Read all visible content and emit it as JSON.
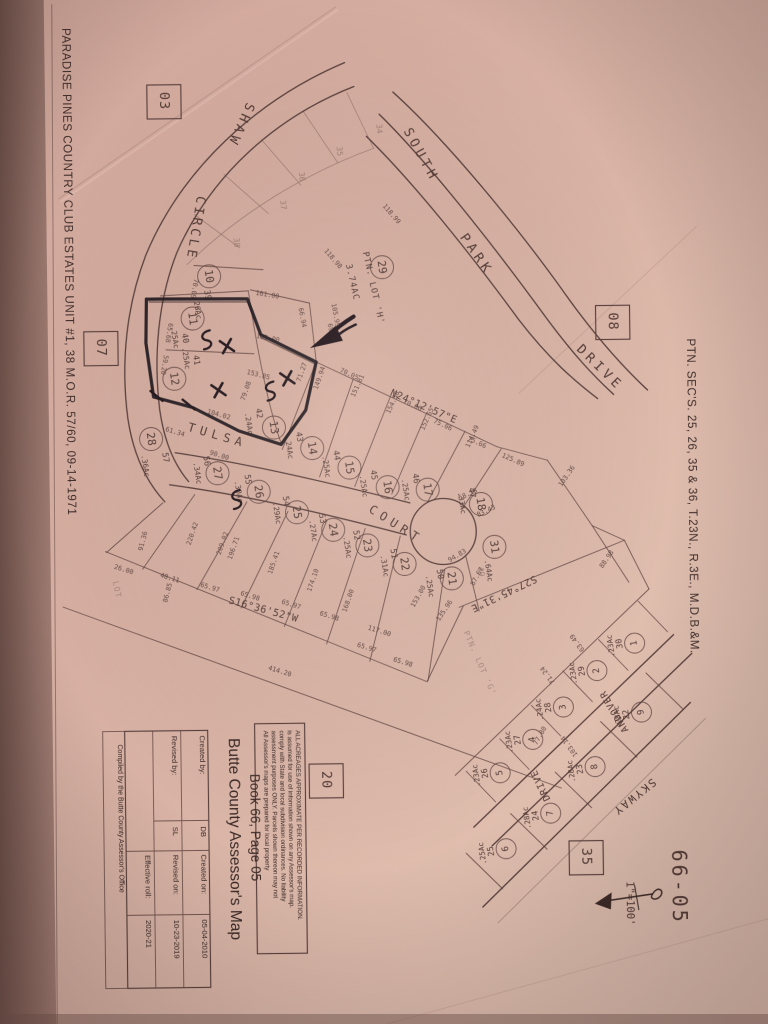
{
  "document": {
    "left_margin_title": "PARADISE PINES COUNTRY CLUB ESTATES UNIT #1, 38 M.O.R. 57/60, 09-14-1971",
    "right_margin_title": "PTN. SEC'S. 25, 26, 35 & 36, T.23N., R.3E., M.D.B.&M.",
    "map_number": "66-05",
    "scale_label": "1\"=100'"
  },
  "colors": {
    "paper": "#dcb6a8",
    "ink": "#5a403c",
    "annotation": "#20181c"
  },
  "title_block": {
    "org_title": "Butte County Assessor's Map",
    "book_page": "Book 66, Page 05",
    "disclaimer": [
      "All Assessor's maps are prepared for local property",
      "assessment purposes ONLY.  Parcels shown thereon may not",
      "comply with State and local subdivision ordinances.  No liability",
      "is assumed for use of information shown on any Assessor's map.",
      "ALL ACREAGES APPROXIMATE PER RECORDED INFORMATION."
    ],
    "created_by_label": "Created by:",
    "created_by_value": "DB",
    "created_on_label": "Created on:",
    "created_on_value": "05-04-2010",
    "revised_by_label": "Revised by:",
    "revised_by_value": "SL",
    "revised_on_label": "Revised on:",
    "revised_on_value": "10-23-2019",
    "effective_roll_label": "Effective roll:",
    "effective_roll_value": "2020-21",
    "compiled_by": "Compiled by the Butte County Assessor's Office"
  },
  "section_boxes": [
    {
      "label": "03",
      "x": 152,
      "y": 82
    },
    {
      "label": "07",
      "x": 86,
      "y": 328
    },
    {
      "label": "08",
      "x": 598,
      "y": 308
    },
    {
      "label": "20",
      "x": 306,
      "y": 763
    },
    {
      "label": "35",
      "x": 565,
      "y": 843
    }
  ],
  "streets": [
    {
      "t": "SHAW",
      "x": 252,
      "y": 100,
      "r": 115,
      "s": 13,
      "sp": 4
    },
    {
      "t": "CIRCLE",
      "x": 201,
      "y": 193,
      "r": 100,
      "s": 13,
      "sp": 3
    },
    {
      "t": "SOUTH",
      "x": 408,
      "y": 131,
      "r": 62,
      "s": 13,
      "sp": 4
    },
    {
      "t": "PARK",
      "x": 463,
      "y": 238,
      "r": 56,
      "s": 13,
      "sp": 4
    },
    {
      "t": "DRIVE",
      "x": 578,
      "y": 352,
      "r": 45,
      "s": 13,
      "sp": 4
    },
    {
      "t": "TULSA",
      "x": 188,
      "y": 428,
      "r": 17,
      "s": 12,
      "sp": 5
    },
    {
      "t": "COURT",
      "x": 368,
      "y": 511,
      "r": 33,
      "s": 12,
      "sp": 5
    },
    {
      "t": "ANDOVER",
      "x": 626,
      "y": 733,
      "r": -120,
      "s": 9.5,
      "sp": 1
    },
    {
      "t": "DRIVE",
      "x": 547,
      "y": 801,
      "r": -115,
      "s": 9.5,
      "sp": 1
    },
    {
      "t": "SKYWAY",
      "x": 649,
      "y": 781,
      "r": 142,
      "s": 11,
      "sp": 2
    }
  ],
  "bearings": [
    {
      "t": "N24°12'57\"E",
      "x": 391,
      "y": 395,
      "r": 24
    },
    {
      "t": "S16°36'52\"W",
      "x": 227,
      "y": 601,
      "r": 16
    },
    {
      "t": "S27°45'31\"E",
      "x": 534,
      "y": 577,
      "r": 155
    }
  ],
  "special_labels": [
    {
      "t": "PTN. LOT 'H'",
      "x": 366,
      "y": 252,
      "r": 78,
      "cls": "sp"
    },
    {
      "t": "3.74AC",
      "x": 349,
      "y": 264,
      "r": 78,
      "cls": "sp"
    },
    {
      "t": "PTN. LOT 'G'",
      "x": 462,
      "y": 633,
      "r": 67,
      "cls": "spf"
    },
    {
      "t": "LOT",
      "x": 112,
      "y": 578,
      "r": 80,
      "cls": "spf"
    }
  ],
  "faint_lot_numbers": [
    {
      "t": "34",
      "x": 381,
      "y": 124
    },
    {
      "t": "35",
      "x": 341,
      "y": 146
    },
    {
      "t": "36",
      "x": 303,
      "y": 171
    },
    {
      "t": "37",
      "x": 284,
      "y": 199
    },
    {
      "t": "38",
      "x": 237,
      "y": 236
    }
  ],
  "parcels": [
    {
      "num": "10",
      "lot": "39",
      "acre": ".26Ac",
      "cx": 212,
      "cy": 274,
      "lx": 207,
      "ly": 288,
      "ax": 196,
      "ay": 295,
      "rot": 82
    },
    {
      "num": "11",
      "lot": "40",
      "acre": ".25Ac",
      "cx": 195,
      "cy": 316,
      "lx": 184,
      "ly": 331,
      "ax": 173,
      "ay": 324,
      "rot": 82
    },
    {
      "num": "12",
      "lot": "41",
      "acre": ".25Ac",
      "cx": 176,
      "cy": 376,
      "lx": 195,
      "ly": 353,
      "ax": 184,
      "ay": 345,
      "rot": 82
    },
    {
      "num": "13",
      "lot": "42",
      "acre": ".24Ac",
      "cx": 275,
      "cy": 426,
      "lx": 257,
      "ly": 407,
      "ax": 246,
      "ay": 411,
      "rot": 82
    },
    {
      "num": "14",
      "lot": "43",
      "acre": ".24Ac",
      "cx": 313,
      "cy": 447,
      "lx": 297,
      "ly": 431,
      "ax": 286,
      "ay": 436,
      "rot": 82
    },
    {
      "num": "15",
      "lot": "44",
      "acre": ".25Ac",
      "cx": 350,
      "cy": 467,
      "lx": 334,
      "ly": 450,
      "ax": 323,
      "ay": 455,
      "rot": 82
    },
    {
      "num": "16",
      "lot": "45",
      "acre": ".25Ac",
      "cx": 388,
      "cy": 487,
      "lx": 371,
      "ly": 470,
      "ax": 360,
      "ay": 475,
      "rot": 82
    },
    {
      "num": "17",
      "lot": "46",
      "acre": ".25Ac",
      "cx": 428,
      "cy": 490,
      "lx": 413,
      "ly": 474,
      "ax": 402,
      "ay": 479,
      "rot": 82
    },
    {
      "num": "18",
      "lot": "47",
      "acre": ".33Ac",
      "cx": 481,
      "cy": 505,
      "lx": 469,
      "ly": 489,
      "ax": 458,
      "ay": 493,
      "rot": 82
    },
    {
      "num": "29",
      "lot": "",
      "acre": "",
      "cx": 385,
      "cy": 267,
      "lx": 0,
      "ly": 0,
      "ax": 0,
      "ay": 0,
      "rot": 82
    },
    {
      "num": "31",
      "lot": "49",
      "acre": ".64Ac",
      "cx": 494,
      "cy": 548,
      "lx": 477,
      "ly": 568,
      "ax": 484,
      "ay": 561,
      "rot": 82,
      "lotFaint": true
    },
    {
      "num": "21",
      "lot": "50",
      "acre": ".25Ac",
      "cx": 451,
      "cy": 579,
      "lx": 436,
      "ly": 570,
      "ax": 425,
      "ay": 576,
      "rot": 82
    },
    {
      "num": "22",
      "lot": "51",
      "acre": ".31Ac",
      "cx": 404,
      "cy": 564,
      "lx": 390,
      "ly": 549,
      "ax": 380,
      "ay": 555,
      "rot": 82
    },
    {
      "num": "23",
      "lot": "52",
      "acre": ".25Ac",
      "cx": 367,
      "cy": 545,
      "lx": 353,
      "ly": 530,
      "ax": 343,
      "ay": 536,
      "rot": 82
    },
    {
      "num": "24",
      "lot": "53",
      "acre": ".27Ac",
      "cx": 333,
      "cy": 529,
      "lx": 319,
      "ly": 513,
      "ax": 309,
      "ay": 519,
      "rot": 82
    },
    {
      "num": "25",
      "lot": "54",
      "acre": ".29Ac",
      "cx": 297,
      "cy": 511,
      "lx": 283,
      "ly": 495,
      "ax": 273,
      "ay": 501,
      "rot": 82
    },
    {
      "num": "26",
      "lot": "55",
      "acre": ".30Ac",
      "cx": 259,
      "cy": 490,
      "lx": 245,
      "ly": 473,
      "ax": 235,
      "ay": 479,
      "rot": 82
    },
    {
      "num": "27",
      "lot": "56",
      "acre": ".34Ac",
      "cx": 218,
      "cy": 471,
      "lx": 204,
      "ly": 454,
      "ax": 194,
      "ay": 460,
      "rot": 82
    },
    {
      "num": "28",
      "lot": "57",
      "acre": ".36Ac",
      "cx": 152,
      "cy": 436,
      "lx": 163,
      "ly": 450,
      "ax": 142,
      "ay": 452,
      "rot": 82
    },
    {
      "num": "1",
      "lot": "30",
      "acre": ".23Ac",
      "cx": 633,
      "cy": 646,
      "lx": 621,
      "ly": 651,
      "ax": 613,
      "ay": 659,
      "rot": -98,
      "small": true
    },
    {
      "num": "2",
      "lot": "29",
      "acre": ".23Ac",
      "cx": 595,
      "cy": 673,
      "lx": 583,
      "ly": 678,
      "ax": 575,
      "ay": 686,
      "rot": -98,
      "small": true
    },
    {
      "num": "3",
      "lot": "28",
      "acre": ".24Ac",
      "cx": 561,
      "cy": 709,
      "lx": 549,
      "ly": 714,
      "ax": 541,
      "ay": 722,
      "rot": -98,
      "small": true
    },
    {
      "num": "4",
      "lot": "27",
      "acre": ".23Ac",
      "cx": 530,
      "cy": 741,
      "lx": 518,
      "ly": 746,
      "ax": 510,
      "ay": 754,
      "rot": -98,
      "small": true
    },
    {
      "num": "5",
      "lot": "26",
      "acre": ".23Ac",
      "cx": 497,
      "cy": 774,
      "lx": 485,
      "ly": 779,
      "ax": 477,
      "ay": 787,
      "rot": -98,
      "small": true
    },
    {
      "num": "9",
      "lot": "22",
      "acre": ".28Ac",
      "cx": 639,
      "cy": 715,
      "lx": 627,
      "ly": 722,
      "ax": 619,
      "ay": 730,
      "rot": -98,
      "small": true
    },
    {
      "num": "8",
      "lot": "23",
      "acre": ".28Ac",
      "cx": 592,
      "cy": 769,
      "lx": 580,
      "ly": 776,
      "ax": 572,
      "ay": 784,
      "rot": -98,
      "small": true
    },
    {
      "num": "7",
      "lot": "24",
      "acre": ".28Ac",
      "cx": 547,
      "cy": 815,
      "lx": 535,
      "ly": 822,
      "ax": 527,
      "ay": 830,
      "rot": -98,
      "small": true
    },
    {
      "num": "6",
      "lot": "25",
      "acre": ".25Ac",
      "cx": 502,
      "cy": 850,
      "lx": 490,
      "ly": 857,
      "ax": 482,
      "ay": 865,
      "rot": -98,
      "small": true
    }
  ],
  "dimensions": [
    {
      "t": "70.09",
      "x": 197,
      "y": 276,
      "r": 100
    },
    {
      "t": "65.68",
      "x": 171,
      "y": 320,
      "r": 100
    },
    {
      "t": "59.20",
      "x": 166,
      "y": 352,
      "r": 100
    },
    {
      "t": "161.00",
      "x": 258,
      "y": 293,
      "r": 10
    },
    {
      "t": "66.94",
      "x": 301,
      "y": 307,
      "r": 80
    },
    {
      "t": "105.99",
      "x": 334,
      "y": 303,
      "r": 80
    },
    {
      "t": "69.84",
      "x": 330,
      "y": 323,
      "r": 80
    },
    {
      "t": "118.99",
      "x": 386,
      "y": 206,
      "r": 50
    },
    {
      "t": "118.98",
      "x": 327,
      "y": 250,
      "r": 50
    },
    {
      "t": "165.00",
      "x": 258,
      "y": 336,
      "r": 12
    },
    {
      "t": "153.85",
      "x": 248,
      "y": 372,
      "r": 15
    },
    {
      "t": "104.02",
      "x": 208,
      "y": 411,
      "r": 16
    },
    {
      "t": "71.27",
      "x": 302,
      "y": 381,
      "r": -70
    },
    {
      "t": "79.08",
      "x": 246,
      "y": 399,
      "r": -70
    },
    {
      "t": "149.94",
      "x": 319,
      "y": 389,
      "r": -70
    },
    {
      "t": "70.05",
      "x": 341,
      "y": 371,
      "r": 25
    },
    {
      "t": "70.06",
      "x": 404,
      "y": 403,
      "r": 25
    },
    {
      "t": "75.06",
      "x": 434,
      "y": 423,
      "r": 25
    },
    {
      "t": "75.66",
      "x": 468,
      "y": 441,
      "r": 25
    },
    {
      "t": "125.89",
      "x": 502,
      "y": 458,
      "r": 25
    },
    {
      "t": "151.81",
      "x": 356,
      "y": 397,
      "r": -65
    },
    {
      "t": "154.58",
      "x": 391,
      "y": 414,
      "r": -65
    },
    {
      "t": "152.65",
      "x": 425,
      "y": 431,
      "r": -65
    },
    {
      "t": "114.49",
      "x": 470,
      "y": 449,
      "r": -65
    },
    {
      "t": "90.00",
      "x": 210,
      "y": 452,
      "r": 18
    },
    {
      "t": "61.34",
      "x": 166,
      "y": 428,
      "r": 18
    },
    {
      "t": "26.00",
      "x": 113,
      "y": 565,
      "r": 18
    },
    {
      "t": "48.11",
      "x": 159,
      "y": 574,
      "r": 18
    },
    {
      "t": "65.97",
      "x": 199,
      "y": 584,
      "r": 18
    },
    {
      "t": "65.98",
      "x": 239,
      "y": 593,
      "r": 18
    },
    {
      "t": "65.97",
      "x": 280,
      "y": 602,
      "r": 18
    },
    {
      "t": "65.98",
      "x": 318,
      "y": 614,
      "r": 18
    },
    {
      "t": "65.97",
      "x": 355,
      "y": 646,
      "r": 18
    },
    {
      "t": "65.98",
      "x": 391,
      "y": 661,
      "r": 18
    },
    {
      "t": "117.00",
      "x": 366,
      "y": 629,
      "r": 18
    },
    {
      "t": "196.71",
      "x": 231,
      "y": 558,
      "r": -70
    },
    {
      "t": "185.41",
      "x": 271,
      "y": 573,
      "r": -70
    },
    {
      "t": "174.10",
      "x": 310,
      "y": 591,
      "r": -70
    },
    {
      "t": "168.00",
      "x": 345,
      "y": 612,
      "r": -70
    },
    {
      "t": "153.00",
      "x": 413,
      "y": 608,
      "r": -60
    },
    {
      "t": "135.96",
      "x": 438,
      "y": 622,
      "r": -55
    },
    {
      "t": "220.42",
      "x": 190,
      "y": 543,
      "r": -70
    },
    {
      "t": "209.02",
      "x": 220,
      "y": 553,
      "r": -70
    },
    {
      "t": "86.85",
      "x": 166,
      "y": 600,
      "r": -75
    },
    {
      "t": "91.36",
      "x": 142,
      "y": 548,
      "r": -75
    },
    {
      "t": "414.20",
      "x": 266,
      "y": 668,
      "r": 18
    },
    {
      "t": "87.67",
      "x": 473,
      "y": 587,
      "r": -60
    },
    {
      "t": "94.83",
      "x": 449,
      "y": 563,
      "r": -30
    },
    {
      "t": "83.43",
      "x": 478,
      "y": 518,
      "r": -25
    },
    {
      "t": "58.18",
      "x": 460,
      "y": 501,
      "r": -25
    },
    {
      "t": "103.36",
      "x": 562,
      "y": 489,
      "r": -55
    },
    {
      "t": "88.98",
      "x": 602,
      "y": 571,
      "r": -55
    },
    {
      "t": "77.80",
      "x": 534,
      "y": 747,
      "r": -60
    },
    {
      "t": "63.49",
      "x": 583,
      "y": 652,
      "r": -125
    },
    {
      "t": "71.24",
      "x": 553,
      "y": 684,
      "r": -125
    },
    {
      "t": "103.14",
      "x": 575,
      "y": 757,
      "r": -125
    }
  ]
}
